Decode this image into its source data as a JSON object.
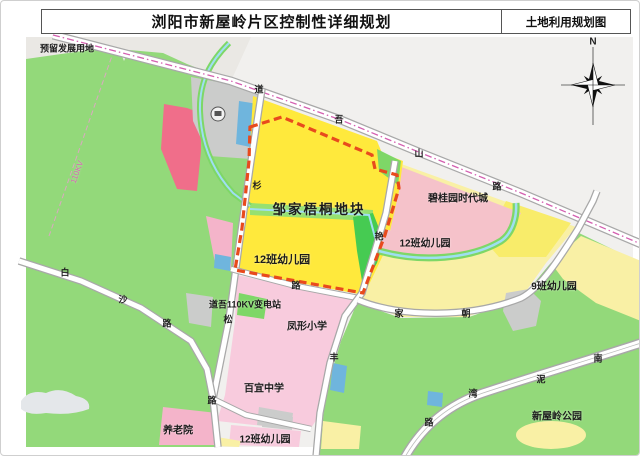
{
  "header": {
    "title": "浏阳市新屋岭片区控制性详细规划",
    "map_type": "土地利用规划图"
  },
  "compass": {
    "north_label": "N"
  },
  "areas": {
    "reserved_land": "预留发展用地",
    "plot_name": "邹家梧桐地块",
    "kindergarten_west": "12班幼儿园",
    "kindergarten_east": "12班幼儿园",
    "kindergarten_south": "12班幼儿园",
    "kindergarten_9class": "9班幼儿园",
    "country_garden_times_city": "碧桂园时代城",
    "substation": "道吾110KV变电站",
    "primary_school": "凤形小学",
    "middle_school": "百宜中学",
    "nursing_home": "养老院",
    "park": "新屋岭公园",
    "power_line": "110KV"
  },
  "roads": {
    "daowushan": {
      "chars": [
        "道",
        "吾",
        "山",
        "路"
      ]
    },
    "shansong": {
      "chars": [
        "杉",
        "松",
        "路"
      ]
    },
    "baisha": {
      "chars": [
        "白",
        "沙",
        "路"
      ]
    },
    "yanfeng": {
      "chars": [
        "艳",
        "丰"
      ]
    },
    "chaojia": {
      "chars": [
        "家",
        "朝"
      ]
    },
    "nanniwan": {
      "chars": [
        "南",
        "泥",
        "湾",
        "路"
      ]
    },
    "east_link": {
      "chars": [
        "路"
      ]
    }
  },
  "colors": {
    "map_bg": "#f1f0ee",
    "corner_gray": "#eae8e4",
    "green_main": "#93d97a",
    "green_mid": "#7ed767",
    "green_bright": "#46cb52",
    "green_band": "#96e070",
    "yellow_plot": "#ffe93c",
    "yellow_bright": "#f8ec6a",
    "yellow_pale": "#f9f0a5",
    "pink_cg": "#f5c2ca",
    "pink_school": "#f8cbdd",
    "pink_block": "#f4b4ca",
    "red_block": "#f06e8a",
    "blue_patch": "#6fb5dd",
    "gray_patch": "#cbcccb",
    "pond": "#e4e7ea",
    "stream": "#9fdef2",
    "road_fill": "#ffffff",
    "road_casing": "#a8a8a8",
    "dash_red": "#e84a1d",
    "dash_magenta": "#d45fb0",
    "power_line_pink": "#e8a0cc"
  }
}
